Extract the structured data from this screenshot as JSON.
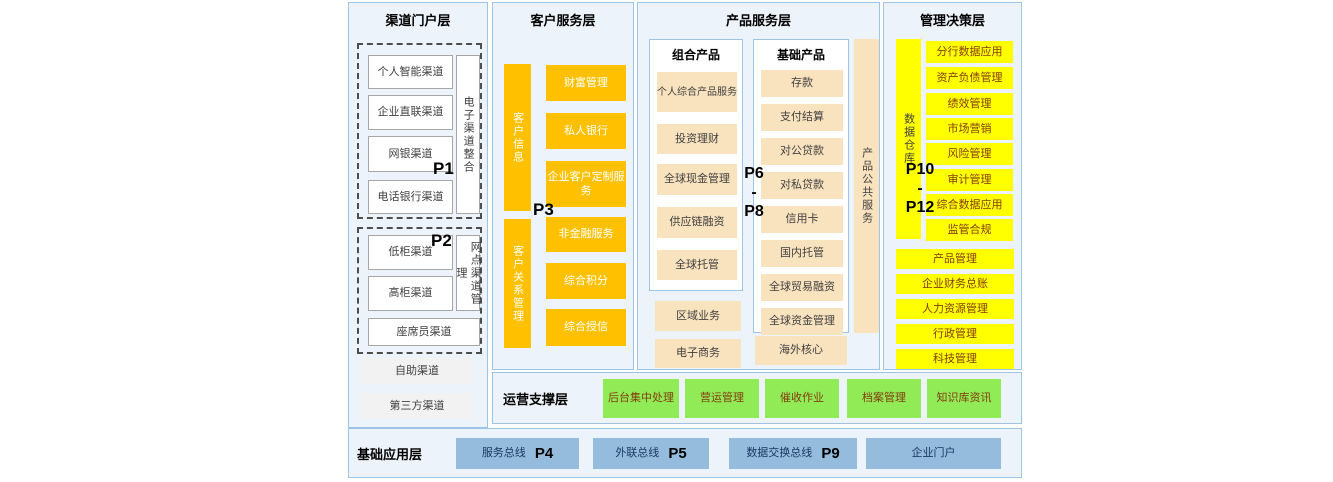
{
  "colors": {
    "panel_bg": "#EDF3FA",
    "panel_border": "#9DC3E6",
    "orange": "#FFC000",
    "cream": "#F9E3BE",
    "yellow": "#FFFF00",
    "green": "#90EB57",
    "blue": "#95BBDD",
    "dark_text": "#404040",
    "brown_text": "#843C0C"
  },
  "channel_layer": {
    "title": "渠道门户层",
    "p1": {
      "tag": "P1",
      "side": "电子渠道整合",
      "items": [
        "个人智能渠道",
        "企业直联渠道",
        "网银渠道",
        "电话银行渠道"
      ]
    },
    "p2": {
      "tag": "P2",
      "side": "网点渠道管理",
      "items": [
        "低柜渠道",
        "高柜渠道"
      ],
      "wide": "座席员渠道"
    },
    "extras": [
      "自助渠道",
      "第三方渠道"
    ]
  },
  "customer_layer": {
    "title": "客户服务层",
    "tag": "P3",
    "group1": {
      "side": "客户信息",
      "items": [
        "财富管理",
        "私人银行",
        "企业客户定制服务"
      ]
    },
    "group2": {
      "side": "客户关系管理",
      "items": [
        "非金融服务",
        "综合积分",
        "综合授信"
      ]
    }
  },
  "product_layer": {
    "title": "产品服务层",
    "tag_top": "P6",
    "tag_sep": "-",
    "tag_bottom": "P8",
    "combo": {
      "title": "组合产品",
      "items": [
        "个人综合产品服务",
        "投资理财",
        "全球现金管理",
        "供应链融资",
        "全球托管"
      ]
    },
    "basic": {
      "title": "基础产品",
      "items": [
        "存款",
        "支付结算",
        "对公贷款",
        "对私贷款",
        "信用卡",
        "国内托管",
        "全球贸易融资",
        "全球资金管理"
      ]
    },
    "combo_extras": [
      "区域业务",
      "电子商务"
    ],
    "basic_extra": "海外核心",
    "strip": "产品公共服务"
  },
  "management_layer": {
    "title": "管理决策层",
    "tag_top": "P10",
    "tag_sep": "-",
    "tag_bottom": "P12",
    "side": "数据仓库",
    "items": [
      "分行数据应用",
      "资产负债管理",
      "绩效管理",
      "市场营销",
      "风险管理",
      "审计管理",
      "综合数据应用",
      "监管合规"
    ],
    "wide_items": [
      "产品管理",
      "企业财务总账",
      "人力资源管理",
      "行政管理",
      "科技管理"
    ]
  },
  "operations_layer": {
    "title": "运营支撑层",
    "items": [
      "后台集中处理",
      "营运管理",
      "催收作业",
      "档案管理",
      "知识库资讯"
    ]
  },
  "foundation_layer": {
    "title": "基础应用层",
    "items": [
      {
        "label": "服务总线",
        "tag": "P4"
      },
      {
        "label": "外联总线",
        "tag": "P5"
      },
      {
        "label": "数据交换总线",
        "tag": "P9"
      },
      {
        "label": "企业门户",
        "tag": ""
      }
    ]
  }
}
